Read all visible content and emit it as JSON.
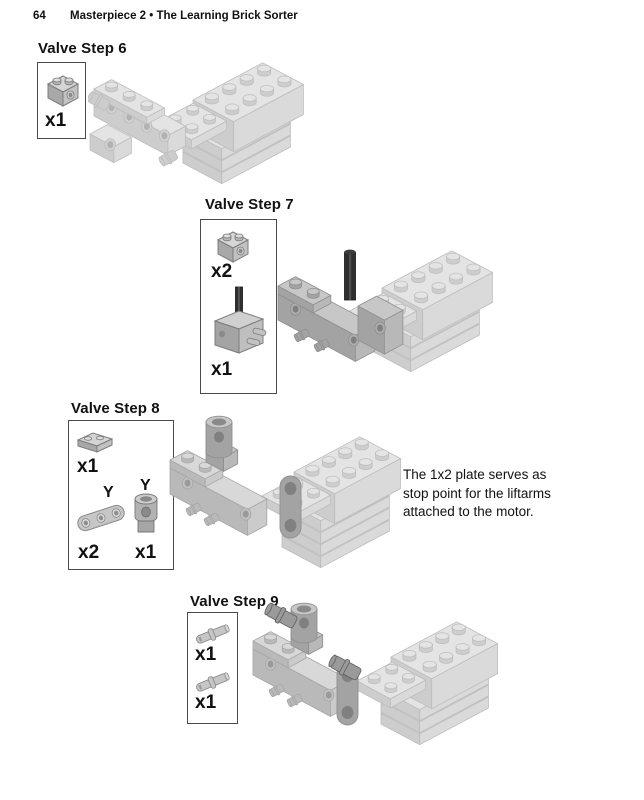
{
  "page": {
    "number": "64",
    "title": "Masterpiece 2 • The Learning Brick Sorter"
  },
  "steps": [
    {
      "label": "Valve Step 6",
      "illustration": "valve-step-6-assembly",
      "parts": [
        {
          "icon": "technic-brick-1x2-icon",
          "qty": "x1"
        }
      ]
    },
    {
      "label": "Valve Step 7",
      "illustration": "valve-step-7-assembly",
      "parts": [
        {
          "icon": "technic-brick-1x2-icon",
          "qty": "x2"
        },
        {
          "icon": "motor-block-with-axle-icon",
          "qty": "x1"
        }
      ]
    },
    {
      "label": "Valve Step 8",
      "illustration": "valve-step-8-assembly",
      "parts": [
        {
          "icon": "plate-1x2-icon",
          "qty": "x1"
        },
        {
          "icon": "liftarm-icon",
          "qty": "x2",
          "marker": "Y"
        },
        {
          "icon": "ball-socket-icon",
          "qty": "x1",
          "marker": "Y"
        }
      ],
      "note_lines": [
        "The 1x2 plate serves as",
        "stop point for the liftarms",
        "attached to the motor."
      ]
    },
    {
      "label": "Valve Step 9",
      "illustration": "valve-step-9-assembly",
      "parts": [
        {
          "icon": "technic-pin-icon",
          "qty": "x1"
        },
        {
          "icon": "technic-pin-icon",
          "qty": "x1"
        }
      ]
    }
  ],
  "colors": {
    "ghost_gray": "#e4e4e4",
    "soft_gray": "#d8d8d8",
    "part_gray": "#c7c7c7",
    "dark_pin_gray": "#9a9a9a",
    "axle_black": "#2e2e2e",
    "box_border": "#4a4a4a",
    "text": "#111111"
  }
}
